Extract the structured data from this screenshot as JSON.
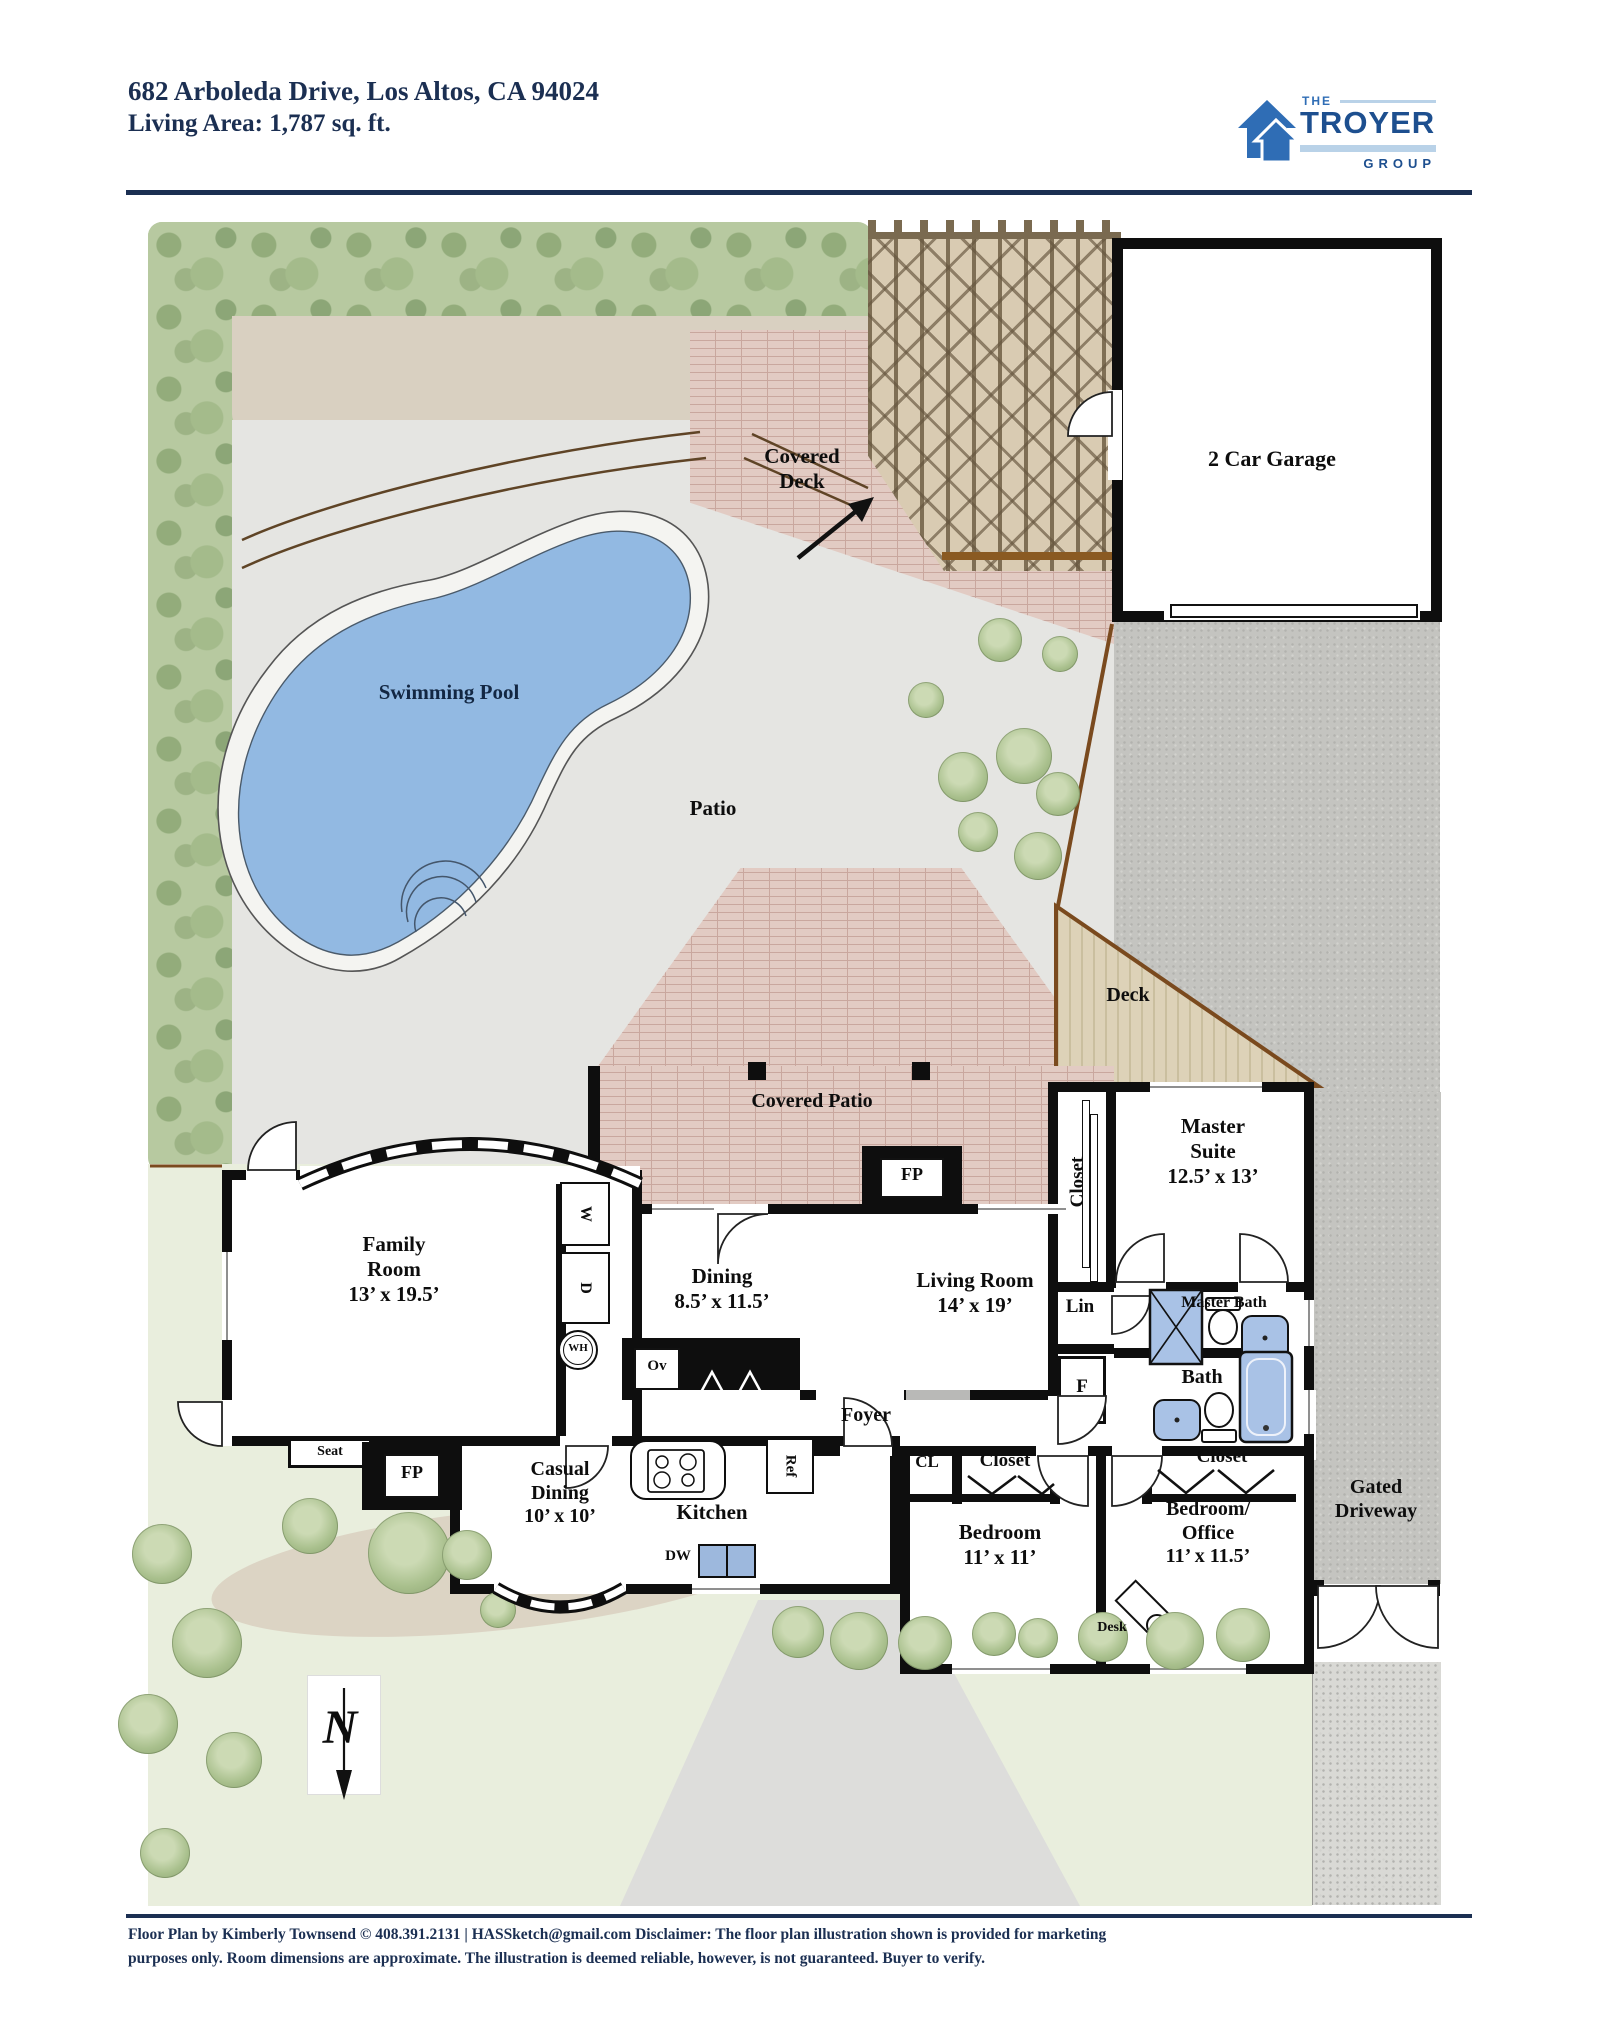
{
  "header": {
    "address": "682 Arboleda Drive, Los Altos, CA 94024",
    "living_area": "Living Area: 1,787 sq. ft.",
    "logo": {
      "the": "THE",
      "name": "TROYER",
      "group": "GROUP"
    }
  },
  "labels": {
    "covered_deck": "Covered\nDeck",
    "garage": "2 Car Garage",
    "swimming_pool": "Swimming Pool",
    "patio": "Patio",
    "deck": "Deck",
    "covered_patio": "Covered Patio",
    "master_suite": "Master\nSuite\n12.5’ x 13’",
    "closet_master": "Closet",
    "lin": "Lin",
    "furnace": "F",
    "master_bath": "Master Bath",
    "bath": "Bath",
    "family_room": "Family\nRoom\n13’ x 19.5’",
    "dining": "Dining\n8.5’ x 11.5’",
    "living_room": "Living Room\n14’ x 19’",
    "foyer": "Foyer",
    "cl": "CL",
    "closet_bedroom": "Closet",
    "closet_office": "Closet",
    "seat": "Seat",
    "fp_family": "FP",
    "fp_living": "FP",
    "casual_dining": "Casual\nDining\n10’ x 10’",
    "kitchen": "Kitchen",
    "dw": "DW",
    "ref": "Ref",
    "ov": "Ov",
    "washer": "W",
    "dryer": "D",
    "water_heater": "WH",
    "bedroom": "Bedroom\n11’ x 11’",
    "bedroom_office": "Bedroom/\nOffice\n11’ x 11.5’",
    "desk": "Desk",
    "gated_driveway": "Gated\nDriveway",
    "north": "N"
  },
  "footer": {
    "line1": "Floor Plan by Kimberly Townsend ©  408.391.2131   |   HASSketch@gmail.com  Disclaimer: The floor plan illustration shown is provided for marketing",
    "line2": "purposes only. Room dimensions are approximate. The illustration is deemed reliable, however, is not guaranteed. Buyer to verify."
  },
  "colors": {
    "navy": "#1b2f52",
    "logo_blue": "#1d4f8f",
    "logo_light_blue": "#b9d2e8",
    "wall_black": "#0e0e0e",
    "pool_water": "#92b9e2",
    "fixture_blue": "#a9c2e6",
    "brick": "#e2cbc3",
    "patio_gray": "#e5e5e2",
    "gravel_gray": "#c4c4c0",
    "lawn_green": "#e9eedd",
    "deck_wood": "#ddd2b8",
    "trellis_tan": "#d9cbb2",
    "fence_brown": "#7a4a1e"
  }
}
